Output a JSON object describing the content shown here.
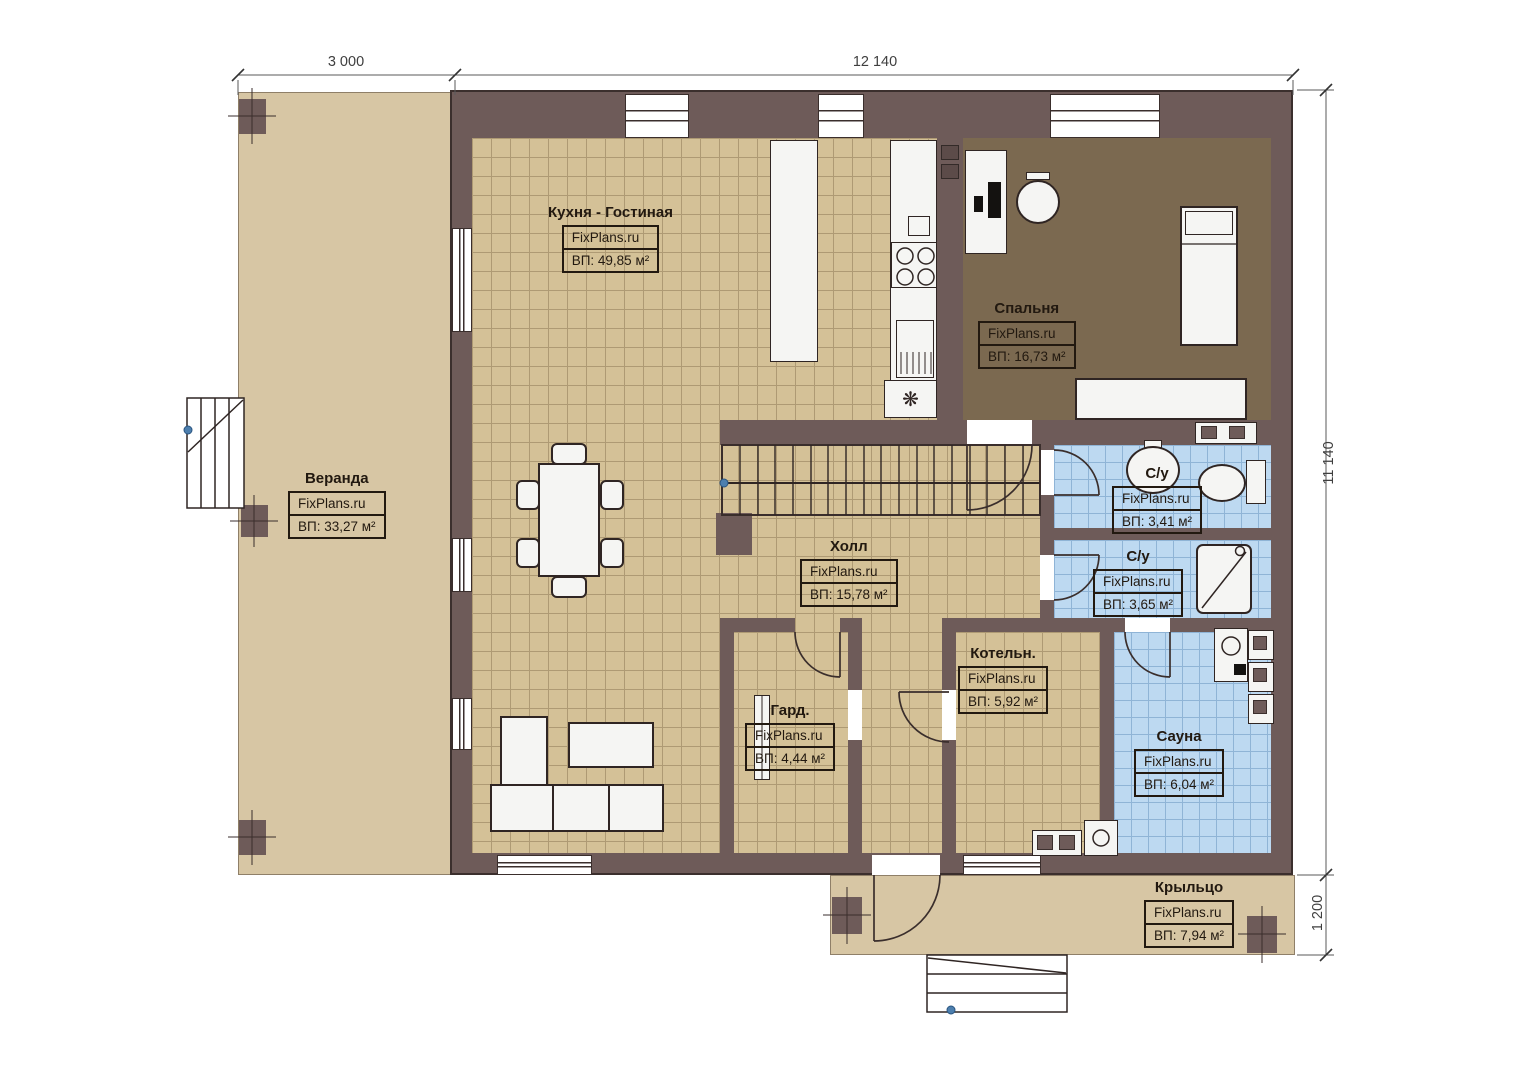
{
  "meta": {
    "watermark": "FixPlans.ru",
    "type_label": "План 1 этажа"
  },
  "dimensions": {
    "top_left": "3 000",
    "top_main": "12 140",
    "right_main": "11 140",
    "right_porch": "1 200"
  },
  "rooms": {
    "veranda": {
      "name": "Веранда",
      "area": "ВП: 33,27 м²"
    },
    "kitchen_living": {
      "name": "Кухня - Гостиная",
      "area": "ВП: 49,85 м²"
    },
    "bedroom": {
      "name": "Спальня",
      "area": "ВП: 16,73 м²"
    },
    "bathroom_top": {
      "name": "С/у",
      "area": "ВП: 3,41 м²"
    },
    "bathroom_mid": {
      "name": "С/у",
      "area": "ВП: 3,65 м²"
    },
    "hall": {
      "name": "Холл",
      "area": "ВП: 15,78 м²"
    },
    "wardrobe": {
      "name": "Гард.",
      "area": "ВП: 4,44 м²"
    },
    "boiler": {
      "name": "Котельн.",
      "area": "ВП: 5,92 м²"
    },
    "sauna": {
      "name": "Сауна",
      "area": "ВП: 6,04 м²"
    },
    "porch": {
      "name": "Крыльцо",
      "area": "ВП: 7,94 м²"
    }
  },
  "colors": {
    "wall": "#6e5b59",
    "tile_beige": "#d4c197",
    "tile_blue": "#bdd9f1",
    "bedroom_floor": "#7b6950",
    "deck": "#d7c6a4",
    "marker_blue": "#4d7fae"
  },
  "icons": {
    "freezer_symbol": "❋"
  }
}
